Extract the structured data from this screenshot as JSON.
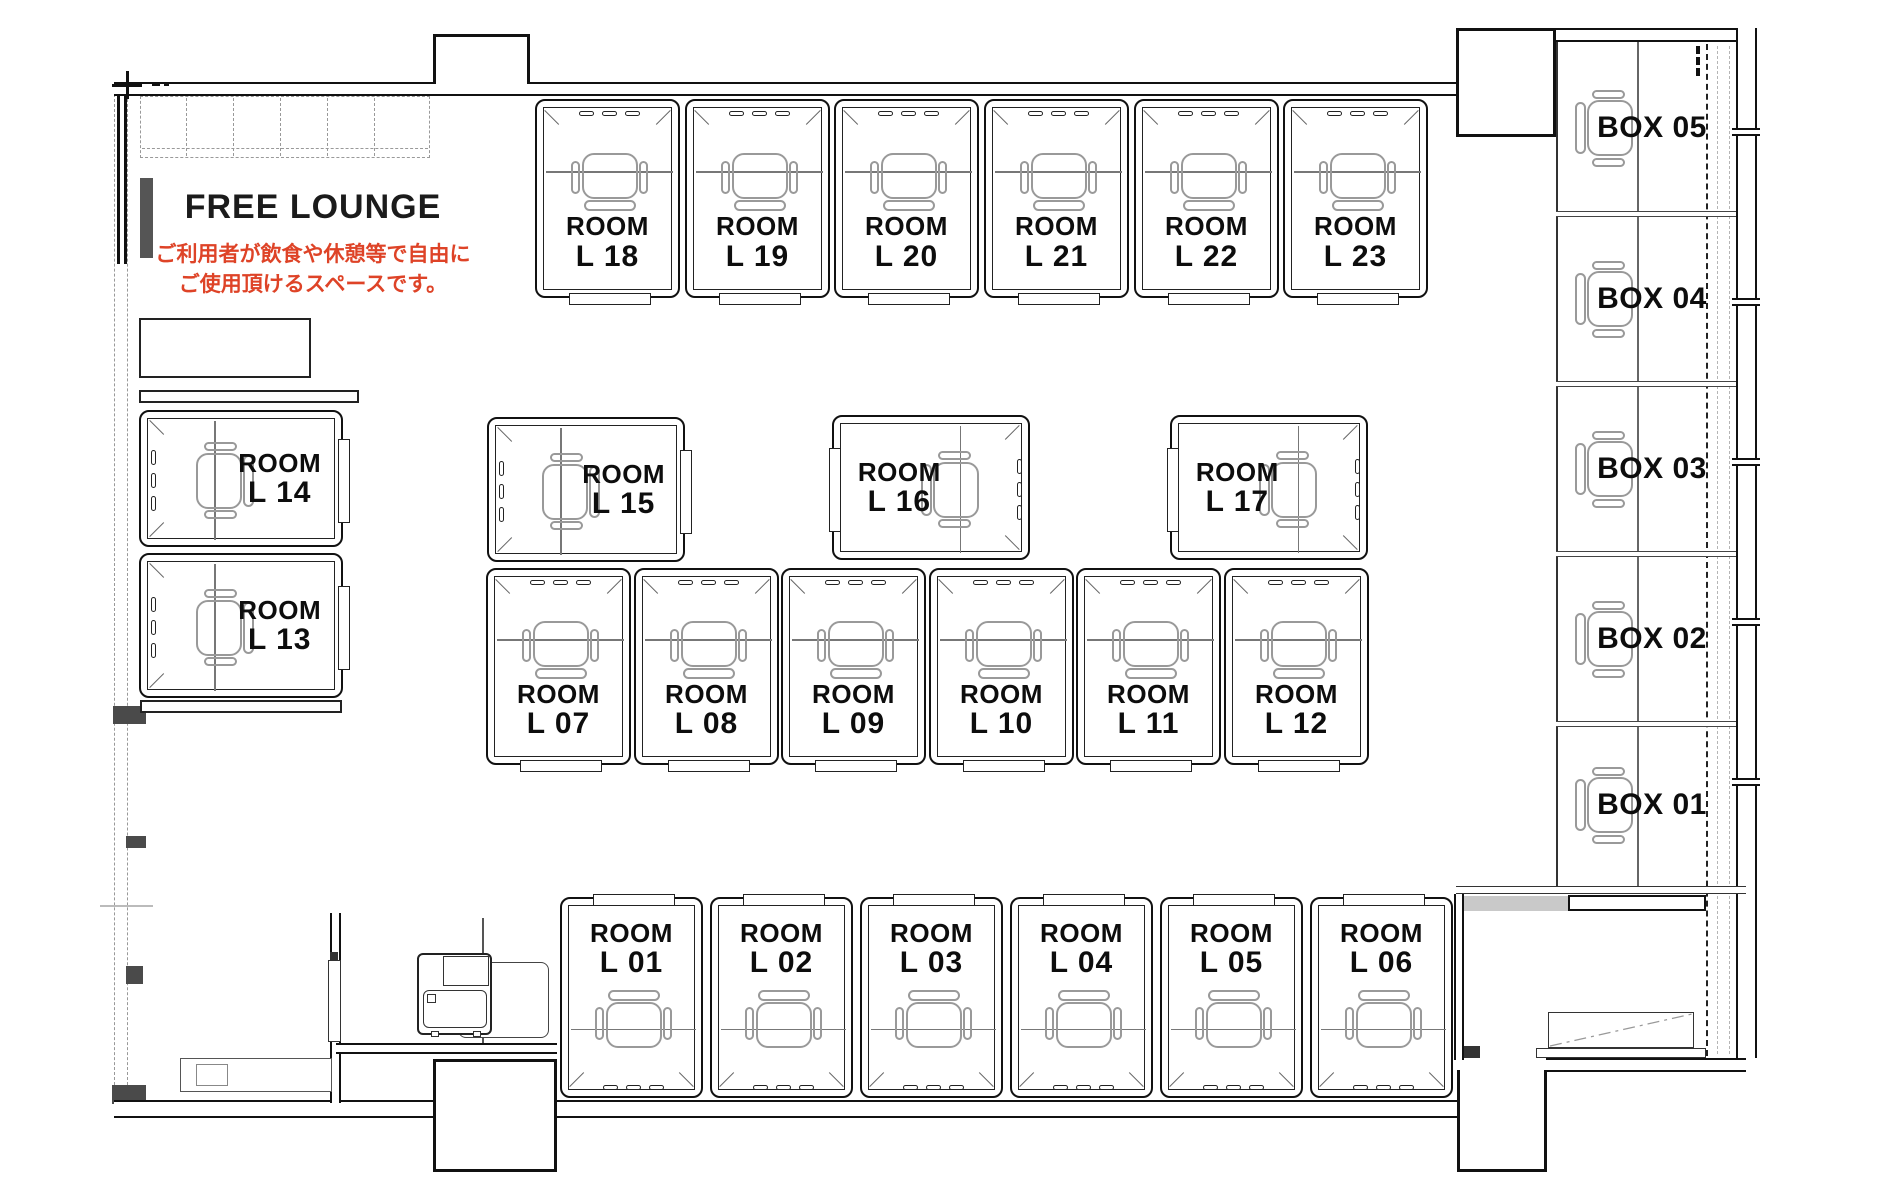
{
  "lounge": {
    "title": "FREE LOUNGE",
    "desc_line1": "ご利用者が飲食や休憩等で自由に",
    "desc_line2": "ご使用頂けるスペースです。"
  },
  "colors": {
    "accent_red": "#de4327",
    "ink": "#111111",
    "chair_gray": "#999999"
  },
  "rooms": [
    {
      "id": "L01",
      "name": "ROOM",
      "num": "L 01",
      "x": 560,
      "y": 897,
      "w": 143,
      "h": 201,
      "orient": "down"
    },
    {
      "id": "L02",
      "name": "ROOM",
      "num": "L 02",
      "x": 710,
      "y": 897,
      "w": 143,
      "h": 201,
      "orient": "down"
    },
    {
      "id": "L03",
      "name": "ROOM",
      "num": "L 03",
      "x": 860,
      "y": 897,
      "w": 143,
      "h": 201,
      "orient": "down"
    },
    {
      "id": "L04",
      "name": "ROOM",
      "num": "L 04",
      "x": 1010,
      "y": 897,
      "w": 143,
      "h": 201,
      "orient": "down"
    },
    {
      "id": "L05",
      "name": "ROOM",
      "num": "L 05",
      "x": 1160,
      "y": 897,
      "w": 143,
      "h": 201,
      "orient": "down"
    },
    {
      "id": "L06",
      "name": "ROOM",
      "num": "L 06",
      "x": 1310,
      "y": 897,
      "w": 143,
      "h": 201,
      "orient": "down"
    },
    {
      "id": "L07",
      "name": "ROOM",
      "num": "L 07",
      "x": 486,
      "y": 568,
      "w": 145,
      "h": 197,
      "orient": "up"
    },
    {
      "id": "L08",
      "name": "ROOM",
      "num": "L 08",
      "x": 634,
      "y": 568,
      "w": 145,
      "h": 197,
      "orient": "up"
    },
    {
      "id": "L09",
      "name": "ROOM",
      "num": "L 09",
      "x": 781,
      "y": 568,
      "w": 145,
      "h": 197,
      "orient": "up"
    },
    {
      "id": "L10",
      "name": "ROOM",
      "num": "L 10",
      "x": 929,
      "y": 568,
      "w": 145,
      "h": 197,
      "orient": "up"
    },
    {
      "id": "L11",
      "name": "ROOM",
      "num": "L 11",
      "x": 1076,
      "y": 568,
      "w": 145,
      "h": 197,
      "orient": "up"
    },
    {
      "id": "L12",
      "name": "ROOM",
      "num": "L 12",
      "x": 1224,
      "y": 568,
      "w": 145,
      "h": 197,
      "orient": "up"
    },
    {
      "id": "L13",
      "name": "ROOM",
      "num": "L 13",
      "x": 139,
      "y": 553,
      "w": 204,
      "h": 145,
      "orient": "left"
    },
    {
      "id": "L14",
      "name": "ROOM",
      "num": "L 14",
      "x": 139,
      "y": 410,
      "w": 204,
      "h": 137,
      "orient": "left"
    },
    {
      "id": "L15",
      "name": "ROOM",
      "num": "L 15",
      "x": 487,
      "y": 417,
      "w": 198,
      "h": 145,
      "orient": "left"
    },
    {
      "id": "L16",
      "name": "ROOM",
      "num": "L 16",
      "x": 832,
      "y": 415,
      "w": 198,
      "h": 145,
      "orient": "right"
    },
    {
      "id": "L17",
      "name": "ROOM",
      "num": "L 17",
      "x": 1170,
      "y": 415,
      "w": 198,
      "h": 145,
      "orient": "right"
    },
    {
      "id": "L18",
      "name": "ROOM",
      "num": "L 18",
      "x": 535,
      "y": 99,
      "w": 145,
      "h": 199,
      "orient": "up"
    },
    {
      "id": "L19",
      "name": "ROOM",
      "num": "L 19",
      "x": 685,
      "y": 99,
      "w": 145,
      "h": 199,
      "orient": "up"
    },
    {
      "id": "L20",
      "name": "ROOM",
      "num": "L 20",
      "x": 834,
      "y": 99,
      "w": 145,
      "h": 199,
      "orient": "up"
    },
    {
      "id": "L21",
      "name": "ROOM",
      "num": "L 21",
      "x": 984,
      "y": 99,
      "w": 145,
      "h": 199,
      "orient": "up"
    },
    {
      "id": "L22",
      "name": "ROOM",
      "num": "L 22",
      "x": 1134,
      "y": 99,
      "w": 145,
      "h": 199,
      "orient": "up"
    },
    {
      "id": "L23",
      "name": "ROOM",
      "num": "L 23",
      "x": 1283,
      "y": 99,
      "w": 145,
      "h": 199,
      "orient": "up"
    }
  ],
  "boxes": [
    {
      "id": "BOX05",
      "label": "BOX 05",
      "y_top": 42,
      "y_bottom": 214
    },
    {
      "id": "BOX04",
      "label": "BOX 04",
      "y_top": 214,
      "y_bottom": 384
    },
    {
      "id": "BOX03",
      "label": "BOX 03",
      "y_top": 384,
      "y_bottom": 554
    },
    {
      "id": "BOX02",
      "label": "BOX 02",
      "y_top": 554,
      "y_bottom": 724
    },
    {
      "id": "BOX01",
      "label": "BOX 01",
      "y_top": 724,
      "y_bottom": 886
    }
  ]
}
